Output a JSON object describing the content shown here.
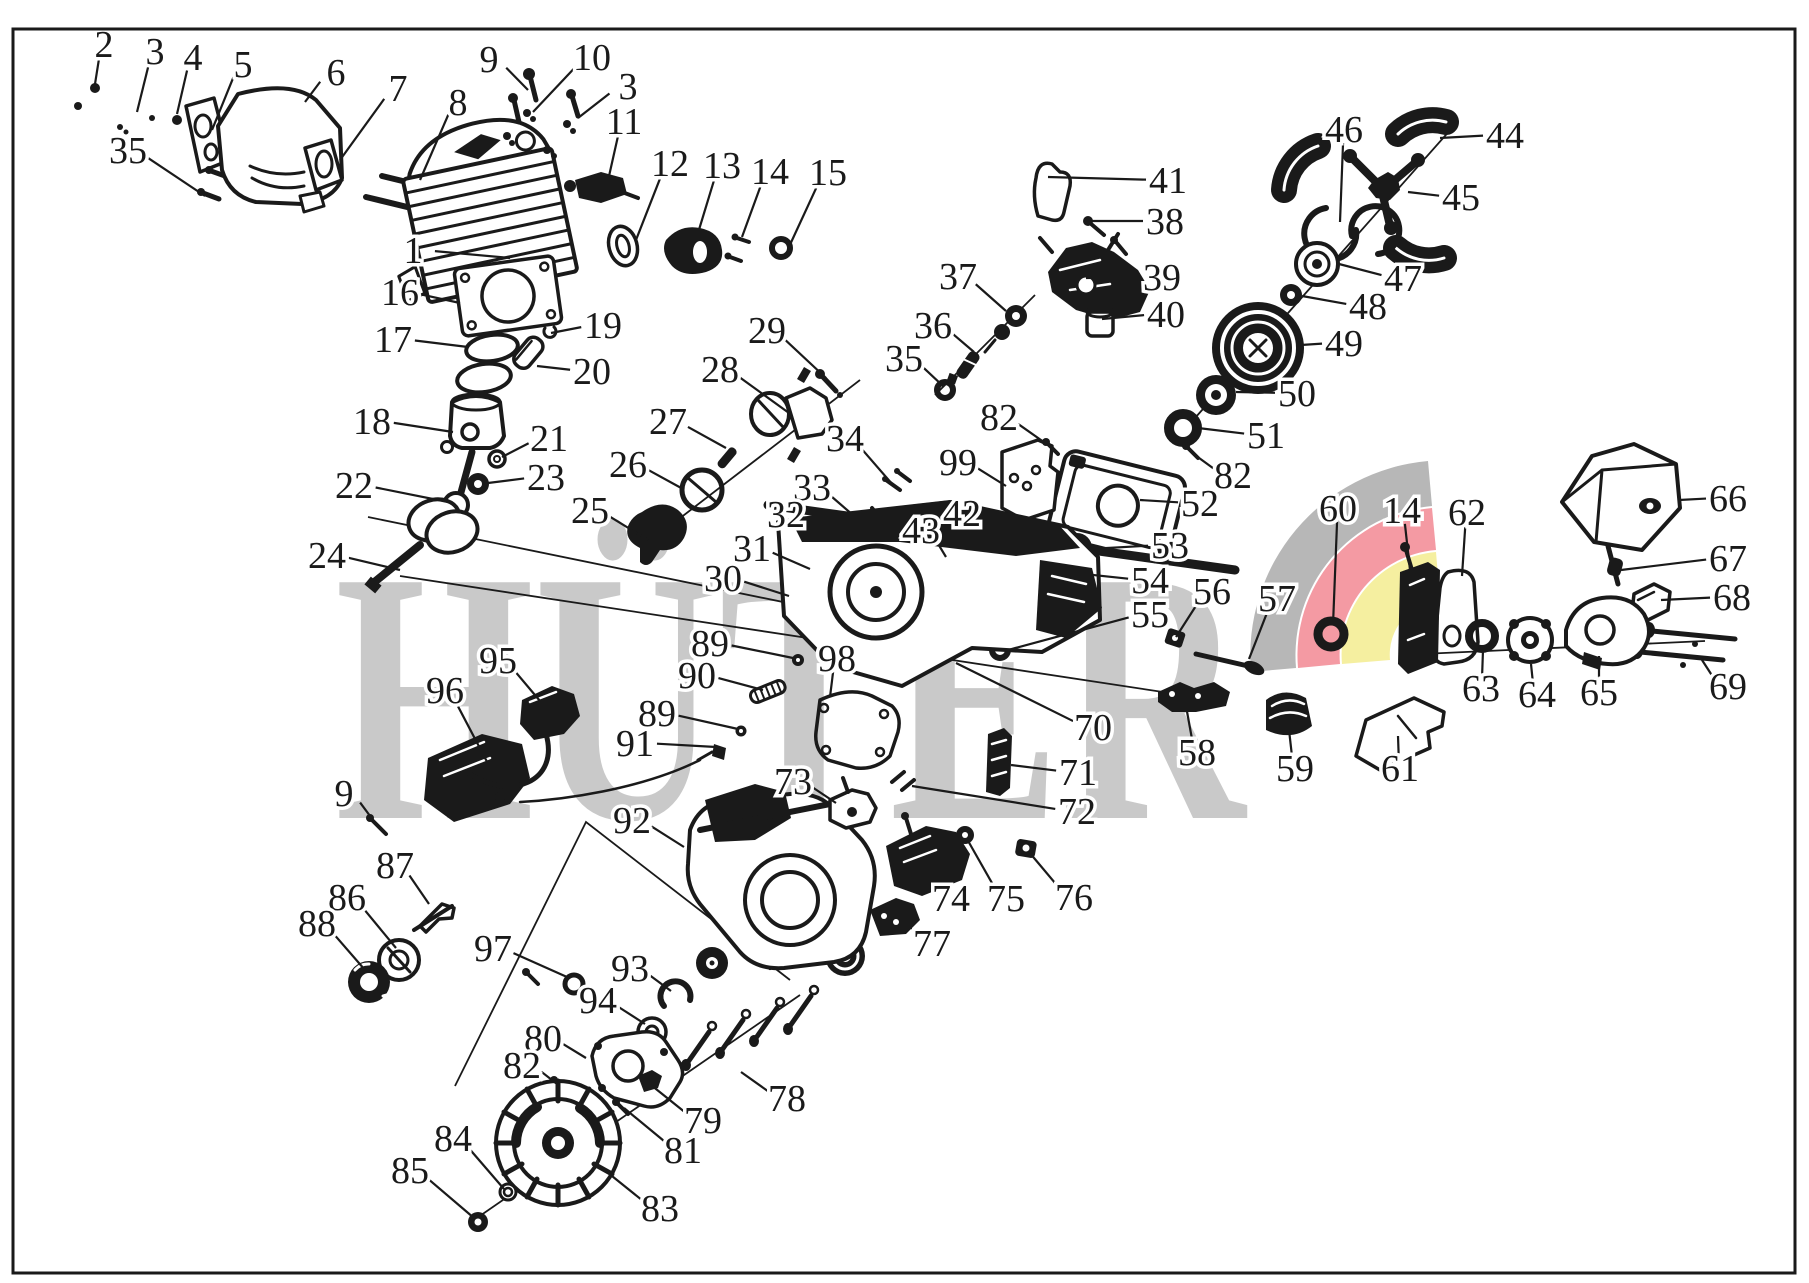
{
  "diagram": {
    "ink_color": "#1a1a1a",
    "background_color": "#ffffff",
    "page_border_color": "#1a1a1a"
  },
  "watermark": {
    "text": "HÜTER",
    "letter_color": "#c9c9c9",
    "swoosh_gray": "#b7b7b7",
    "swoosh_red": "#f49aa3",
    "swoosh_yellow": "#f5efa0"
  },
  "labels": [
    {
      "n": "2",
      "x": 104,
      "y": 44,
      "tx": 95,
      "ty": 84
    },
    {
      "n": "3",
      "x": 155,
      "y": 51,
      "tx": 137,
      "ty": 112
    },
    {
      "n": "4",
      "x": 193,
      "y": 57,
      "tx": 177,
      "ty": 114
    },
    {
      "n": "5",
      "x": 243,
      "y": 64,
      "tx": 212,
      "ty": 130
    },
    {
      "n": "6",
      "x": 336,
      "y": 72,
      "tx": 305,
      "ty": 102
    },
    {
      "n": "7",
      "x": 398,
      "y": 88,
      "tx": 340,
      "ty": 160
    },
    {
      "n": "8",
      "x": 458,
      "y": 102,
      "tx": 420,
      "ty": 180
    },
    {
      "n": "35",
      "x": 128,
      "y": 150,
      "tx": 205,
      "ty": 196
    },
    {
      "n": "9",
      "x": 489,
      "y": 59,
      "tx": 528,
      "ty": 90
    },
    {
      "n": "10",
      "x": 592,
      "y": 57,
      "tx": 533,
      "ty": 112
    },
    {
      "n": "3",
      "x": 628,
      "y": 86,
      "tx": 578,
      "ty": 118
    },
    {
      "n": "11",
      "x": 624,
      "y": 121,
      "tx": 607,
      "ty": 185
    },
    {
      "n": "12",
      "x": 670,
      "y": 163,
      "tx": 636,
      "ty": 240
    },
    {
      "n": "13",
      "x": 722,
      "y": 165,
      "tx": 698,
      "ty": 233
    },
    {
      "n": "14",
      "x": 770,
      "y": 171,
      "tx": 742,
      "ty": 237
    },
    {
      "n": "15",
      "x": 828,
      "y": 172,
      "tx": 788,
      "ty": 249
    },
    {
      "n": "1",
      "x": 413,
      "y": 250,
      "tx": 510,
      "ty": 258
    },
    {
      "n": "16",
      "x": 400,
      "y": 292,
      "tx": 460,
      "ty": 303
    },
    {
      "n": "17",
      "x": 393,
      "y": 339,
      "tx": 468,
      "ty": 347
    },
    {
      "n": "19",
      "x": 603,
      "y": 325,
      "tx": 551,
      "ty": 333
    },
    {
      "n": "20",
      "x": 592,
      "y": 371,
      "tx": 537,
      "ty": 366
    },
    {
      "n": "18",
      "x": 372,
      "y": 421,
      "tx": 453,
      "ty": 432
    },
    {
      "n": "21",
      "x": 549,
      "y": 438,
      "tx": 502,
      "ty": 457
    },
    {
      "n": "23",
      "x": 546,
      "y": 477,
      "tx": 488,
      "ty": 483
    },
    {
      "n": "22",
      "x": 354,
      "y": 485,
      "tx": 448,
      "ty": 502
    },
    {
      "n": "24",
      "x": 327,
      "y": 555,
      "tx": 400,
      "ty": 570
    },
    {
      "n": "29",
      "x": 767,
      "y": 330,
      "tx": 826,
      "ty": 378
    },
    {
      "n": "28",
      "x": 720,
      "y": 369,
      "tx": 789,
      "ty": 413
    },
    {
      "n": "27",
      "x": 668,
      "y": 421,
      "tx": 726,
      "ty": 448
    },
    {
      "n": "26",
      "x": 628,
      "y": 464,
      "tx": 683,
      "ty": 489
    },
    {
      "n": "25",
      "x": 590,
      "y": 510,
      "tx": 648,
      "ty": 540
    },
    {
      "n": "34",
      "x": 845,
      "y": 438,
      "tx": 893,
      "ty": 485
    },
    {
      "n": "33",
      "x": 812,
      "y": 487,
      "tx": 861,
      "ty": 522
    },
    {
      "n": "32",
      "x": 786,
      "y": 514,
      "tx": 824,
      "ty": 539
    },
    {
      "n": "31",
      "x": 752,
      "y": 548,
      "tx": 810,
      "ty": 569
    },
    {
      "n": "30",
      "x": 723,
      "y": 578,
      "tx": 789,
      "ty": 596
    },
    {
      "n": "43",
      "x": 921,
      "y": 530,
      "tx": 946,
      "ty": 557
    },
    {
      "n": "42",
      "x": 962,
      "y": 513,
      "tx": 994,
      "ty": 537
    },
    {
      "n": "37",
      "x": 958,
      "y": 276,
      "tx": 1006,
      "ty": 311
    },
    {
      "n": "36",
      "x": 933,
      "y": 325,
      "tx": 974,
      "ty": 352
    },
    {
      "n": "35",
      "x": 904,
      "y": 358,
      "tx": 943,
      "ty": 386
    },
    {
      "n": "41",
      "x": 1168,
      "y": 180,
      "tx": 1048,
      "ty": 177
    },
    {
      "n": "38",
      "x": 1165,
      "y": 221,
      "tx": 1088,
      "ty": 221
    },
    {
      "n": "39",
      "x": 1162,
      "y": 277,
      "tx": 1086,
      "ty": 278
    },
    {
      "n": "40",
      "x": 1166,
      "y": 314,
      "tx": 1102,
      "ty": 319
    },
    {
      "n": "46",
      "x": 1344,
      "y": 129,
      "tx": 1340,
      "ty": 222
    },
    {
      "n": "44",
      "x": 1505,
      "y": 135,
      "tx": 1440,
      "ty": 138
    },
    {
      "n": "45",
      "x": 1461,
      "y": 197,
      "tx": 1408,
      "ty": 192
    },
    {
      "n": "47",
      "x": 1403,
      "y": 278,
      "tx": 1339,
      "ty": 264
    },
    {
      "n": "48",
      "x": 1368,
      "y": 306,
      "tx": 1302,
      "ty": 296
    },
    {
      "n": "49",
      "x": 1344,
      "y": 343,
      "tx": 1301,
      "ty": 345
    },
    {
      "n": "50",
      "x": 1297,
      "y": 393,
      "tx": 1236,
      "ty": 392
    },
    {
      "n": "51",
      "x": 1266,
      "y": 435,
      "tx": 1198,
      "ty": 428
    },
    {
      "n": "82",
      "x": 999,
      "y": 417,
      "tx": 1048,
      "ty": 445
    },
    {
      "n": "82",
      "x": 1233,
      "y": 475,
      "tx": 1195,
      "ty": 455
    },
    {
      "n": "99",
      "x": 958,
      "y": 462,
      "tx": 1006,
      "ty": 486
    },
    {
      "n": "52",
      "x": 1200,
      "y": 503,
      "tx": 1140,
      "ty": 500
    },
    {
      "n": "53",
      "x": 1170,
      "y": 545,
      "tx": 1089,
      "ty": 549
    },
    {
      "n": "54",
      "x": 1150,
      "y": 580,
      "tx": 1046,
      "ty": 570
    },
    {
      "n": "55",
      "x": 1150,
      "y": 614,
      "tx": 1008,
      "ty": 650
    },
    {
      "n": "56",
      "x": 1212,
      "y": 591,
      "tx": 1176,
      "ty": 637
    },
    {
      "n": "57",
      "x": 1277,
      "y": 598,
      "tx": 1249,
      "ty": 659
    },
    {
      "n": "60",
      "x": 1338,
      "y": 508,
      "tx": 1333,
      "ty": 625
    },
    {
      "n": "14",
      "x": 1402,
      "y": 510,
      "tx": 1410,
      "ty": 570
    },
    {
      "n": "62",
      "x": 1467,
      "y": 512,
      "tx": 1462,
      "ty": 576
    },
    {
      "n": "66",
      "x": 1728,
      "y": 498,
      "tx": 1679,
      "ty": 500
    },
    {
      "n": "67",
      "x": 1728,
      "y": 558,
      "tx": 1621,
      "ty": 570
    },
    {
      "n": "68",
      "x": 1732,
      "y": 597,
      "tx": 1661,
      "ty": 600
    },
    {
      "n": "69",
      "x": 1728,
      "y": 686,
      "tx": 1702,
      "ty": 660
    },
    {
      "n": "63",
      "x": 1481,
      "y": 688,
      "tx": 1483,
      "ty": 650
    },
    {
      "n": "64",
      "x": 1537,
      "y": 694,
      "tx": 1531,
      "ty": 664
    },
    {
      "n": "65",
      "x": 1599,
      "y": 692,
      "tx": 1599,
      "ty": 656
    },
    {
      "n": "61",
      "x": 1400,
      "y": 768,
      "tx": 1398,
      "ty": 736
    },
    {
      "n": "59",
      "x": 1295,
      "y": 768,
      "tx": 1288,
      "ty": 721
    },
    {
      "n": "58",
      "x": 1197,
      "y": 752,
      "tx": 1186,
      "ty": 706
    },
    {
      "n": "70",
      "x": 1093,
      "y": 727,
      "tx": 956,
      "ty": 663
    },
    {
      "n": "71",
      "x": 1078,
      "y": 772,
      "tx": 1011,
      "ty": 765
    },
    {
      "n": "72",
      "x": 1077,
      "y": 811,
      "tx": 912,
      "ty": 786
    },
    {
      "n": "98",
      "x": 837,
      "y": 658,
      "tx": 830,
      "ty": 697
    },
    {
      "n": "89",
      "x": 710,
      "y": 643,
      "tx": 793,
      "ty": 658
    },
    {
      "n": "90",
      "x": 697,
      "y": 675,
      "tx": 763,
      "ty": 690
    },
    {
      "n": "89",
      "x": 657,
      "y": 713,
      "tx": 738,
      "ty": 729
    },
    {
      "n": "91",
      "x": 635,
      "y": 743,
      "tx": 716,
      "ty": 747
    },
    {
      "n": "73",
      "x": 793,
      "y": 781,
      "tx": 836,
      "ty": 803
    },
    {
      "n": "74",
      "x": 951,
      "y": 898,
      "tx": 921,
      "ty": 859
    },
    {
      "n": "75",
      "x": 1006,
      "y": 898,
      "tx": 967,
      "ty": 839
    },
    {
      "n": "76",
      "x": 1074,
      "y": 897,
      "tx": 1029,
      "ty": 852
    },
    {
      "n": "77",
      "x": 932,
      "y": 943,
      "tx": 896,
      "ty": 908
    },
    {
      "n": "95",
      "x": 498,
      "y": 660,
      "tx": 540,
      "ty": 701
    },
    {
      "n": "96",
      "x": 445,
      "y": 690,
      "tx": 506,
      "ty": 798
    },
    {
      "n": "9",
      "x": 344,
      "y": 793,
      "tx": 373,
      "ty": 820
    },
    {
      "n": "87",
      "x": 395,
      "y": 865,
      "tx": 429,
      "ty": 904
    },
    {
      "n": "86",
      "x": 347,
      "y": 897,
      "tx": 396,
      "ty": 948
    },
    {
      "n": "88",
      "x": 317,
      "y": 923,
      "tx": 365,
      "ty": 970
    },
    {
      "n": "97",
      "x": 493,
      "y": 948,
      "tx": 567,
      "ty": 977
    },
    {
      "n": "92",
      "x": 632,
      "y": 820,
      "tx": 684,
      "ty": 847
    },
    {
      "n": "93",
      "x": 630,
      "y": 968,
      "tx": 671,
      "ty": 991
    },
    {
      "n": "94",
      "x": 598,
      "y": 1000,
      "tx": 645,
      "ty": 1024
    },
    {
      "n": "80",
      "x": 543,
      "y": 1038,
      "tx": 586,
      "ty": 1058
    },
    {
      "n": "82",
      "x": 522,
      "y": 1065,
      "tx": 557,
      "ty": 1084
    },
    {
      "n": "79",
      "x": 703,
      "y": 1120,
      "tx": 646,
      "ty": 1081
    },
    {
      "n": "81",
      "x": 683,
      "y": 1150,
      "tx": 624,
      "ty": 1108
    },
    {
      "n": "84",
      "x": 453,
      "y": 1138,
      "tx": 504,
      "ty": 1189
    },
    {
      "n": "85",
      "x": 410,
      "y": 1170,
      "tx": 474,
      "ty": 1218
    },
    {
      "n": "83",
      "x": 660,
      "y": 1208,
      "tx": 602,
      "ty": 1168
    },
    {
      "n": "78",
      "x": 787,
      "y": 1098,
      "tx": 741,
      "ty": 1072
    }
  ]
}
